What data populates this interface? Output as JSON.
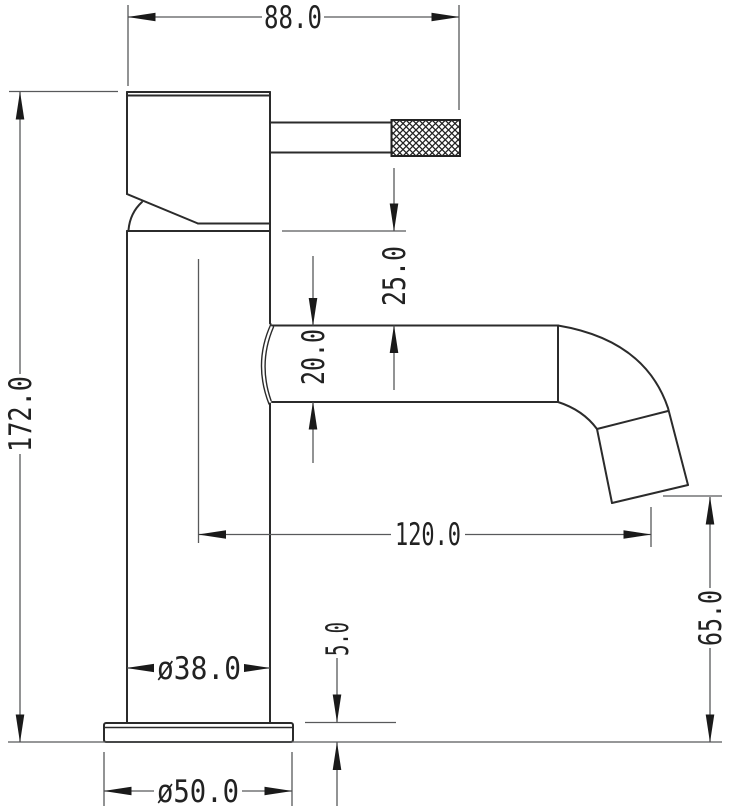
{
  "drawing": {
    "type": "technical-dimension-drawing",
    "subject": "basin mixer tap side elevation",
    "background_color": "#ffffff",
    "object_line_color": "#2b2b2b",
    "dimension_line_color": "#58595b",
    "text_color": "#222222",
    "labels": {
      "top_width": "88.0",
      "overall_height": "172.0",
      "handle_to_spout_gap": "25.0",
      "spout_tube_height": "20.0",
      "spout_reach": "120.0",
      "spout_outlet_height": "65.0",
      "base_plate_thickness": "5.0",
      "body_diameter": "ø38.0",
      "base_diameter": "ø50.0"
    }
  }
}
